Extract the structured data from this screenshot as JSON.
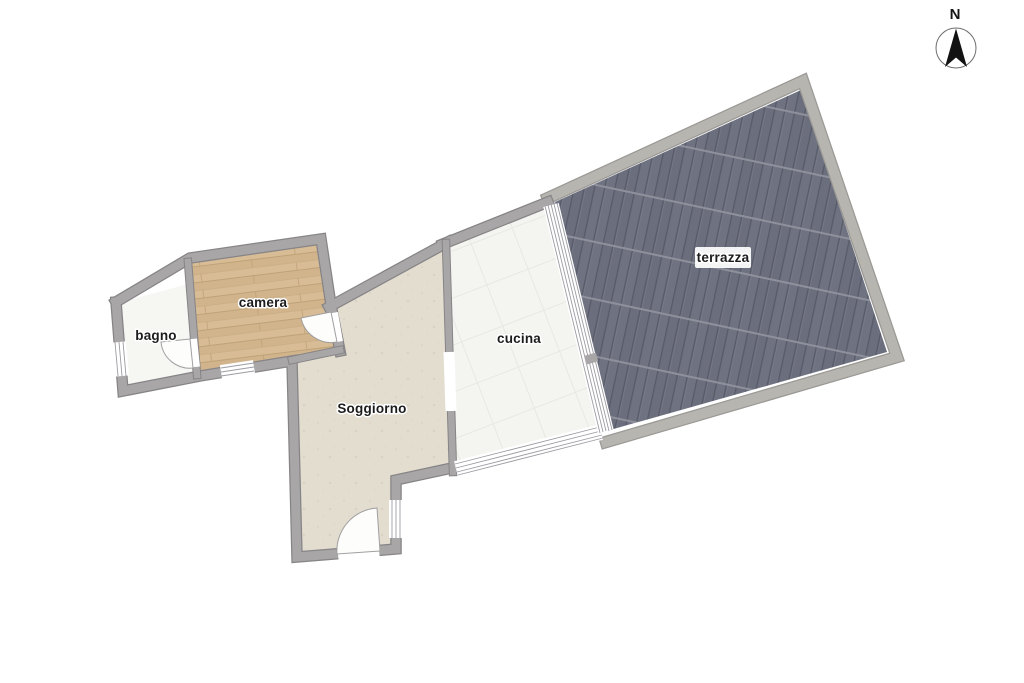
{
  "document": {
    "kind": "apartment floor plan",
    "background": "#ffffff"
  },
  "compass": {
    "label": "N"
  },
  "rooms": {
    "bagno": {
      "label": "bagno"
    },
    "camera": {
      "label": "camera"
    },
    "soggiorno": {
      "label": "Soggiorno"
    },
    "cucina": {
      "label": "cucina"
    },
    "terrazza": {
      "label": "terrazza"
    }
  },
  "colors": {
    "interior_wall": "#a8a6a7",
    "terrace_wall": "#b7b5b0",
    "wood_floor": "#d7bc96",
    "deck_floor": "#6f7280",
    "soggiorno_floor": "#e3ddd0",
    "cucina_floor": "#f4f4f1",
    "bagno_floor": "#f6f6f3",
    "label_text": "#1c1c1c"
  }
}
